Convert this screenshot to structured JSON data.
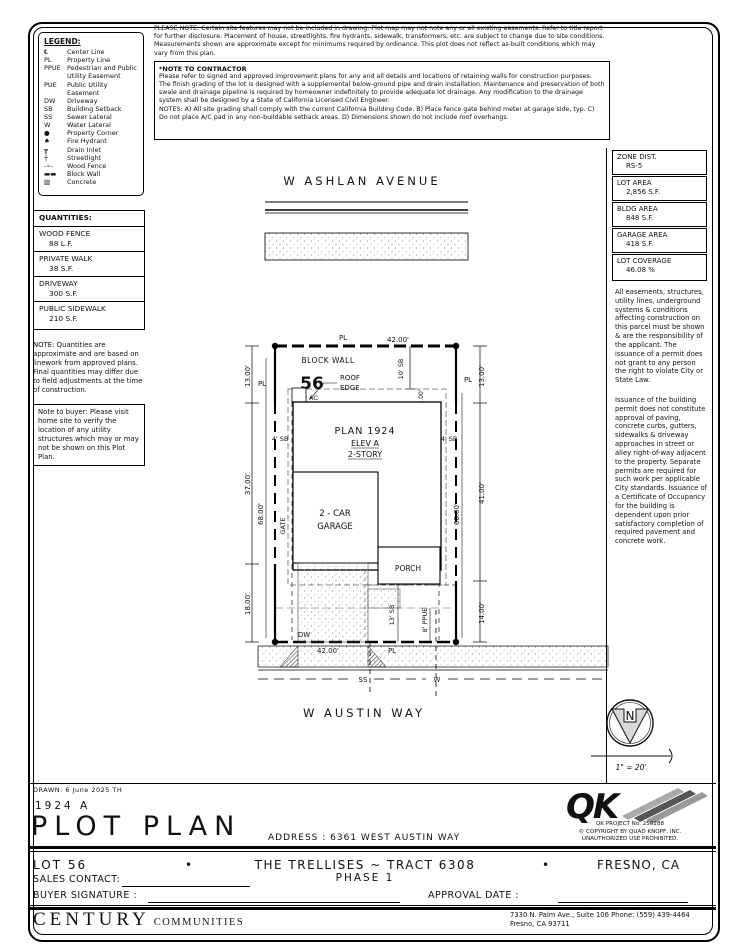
{
  "legend": {
    "title": "LEGEND:",
    "items": [
      {
        "symbol": "℄",
        "label": "Center Line"
      },
      {
        "symbol": "PL",
        "label": "Property Line"
      },
      {
        "symbol": "PPUE",
        "label": "Pedestrian and Public Utility Easement"
      },
      {
        "symbol": "PUE",
        "label": "Public Utility Easement"
      },
      {
        "symbol": "DW",
        "label": "Driveway"
      },
      {
        "symbol": "SB",
        "label": "Building Setback"
      },
      {
        "symbol": "SS",
        "label": "Sewer Lateral"
      },
      {
        "symbol": "W",
        "label": "Water Lateral"
      },
      {
        "symbol": "●",
        "label": "Property Corner"
      },
      {
        "symbol": "♠",
        "label": "Fire Hydrant"
      },
      {
        "symbol": "┳",
        "label": "Drain Inlet"
      },
      {
        "symbol": "┼",
        "label": "Streetlight"
      },
      {
        "symbol": "-∘-",
        "label": "Wood Fence"
      },
      {
        "symbol": "▬▬",
        "label": "Block Wall"
      },
      {
        "symbol": "▨",
        "label": "Concrete"
      }
    ]
  },
  "top_note": "PLEASE NOTE:  Certain site features may not be included in drawing.  Plot map may not note any or all existing easements. Refer to title report for further disclosure.  Placement of house, streetlights, fire hydrants, sidewalk, transformers, etc. are subject to change due to site conditions.  Measurements shown are approximate except for minimums required by ordinance.  This plot does not reflect as-built conditions which may vary from this plan.",
  "contractor_note": {
    "title": "*NOTE TO CONTRACTOR",
    "body": "Please refer to signed and approved improvement plans for any and all details and locations of retaining walls for construction purposes. The finish grading of the lot is designed with a supplemental below-ground pipe and drain installation.  Maintenance and preservation of both swale and drainage pipeline is required by homeowner indefinitely to provide adequate lot drainage.  Any modification to the drainage system shall be designed by a State of California Licensed Civil Engineer.",
    "notes": "NOTES:  A) All site grading shall comply with the current California Building Code.  B) Place fence gate behind meter at garage side, typ.  C) Do not place A/C pad in any non-buildable setback areas.  D) Dimensions shown do not include roof overhangs."
  },
  "site_info": {
    "boxes": [
      {
        "label": "ZONE DIST.",
        "value": "RS-5"
      },
      {
        "label": "LOT AREA",
        "value": "2,856 S.F."
      },
      {
        "label": "BLDG AREA",
        "value": "848 S.F."
      },
      {
        "label": "GARAGE AREA",
        "value": "418 S.F."
      },
      {
        "label": "LOT COVERAGE",
        "value": "46.08 %"
      }
    ],
    "para1": "All easements, structures, utility lines, underground systems & conditions affecting construction on this parcel must be shown & are the responsibility of the applicant. The issuance of a permit does not grant to any person the right to violate City or State Law.",
    "para2": "Issuance of the building permit does not constitute approval of paving, concrete curbs, gutters, sidewalks & driveway approaches in street or alley right-of-way adjacent to the property. Separate permits are required for such work per applicable City standards. Issuance of a Certificate of Occupancy for the building is dependent upon prior satisfactory completion of required pavement and concrete work."
  },
  "quantities": {
    "title": "QUANTITIES:",
    "items": [
      {
        "label": "WOOD FENCE",
        "value": "88 L.F."
      },
      {
        "label": "PRIVATE WALK",
        "value": "38 S.F."
      },
      {
        "label": "DRIVEWAY",
        "value": "300 S.F."
      },
      {
        "label": "PUBLIC SIDEWALK",
        "value": "210 S.F."
      }
    ],
    "note": "NOTE: Quantities are approximate and are based on linework from approved plans.  Final quantities may differ due to field adjustments at the time of construction.",
    "buyer_note": "Note to buyer: Please visit home site to verify the location of any utility structures which may or may not be shown on this Plot Plan."
  },
  "plot": {
    "labels": {
      "street_top": "W ASHLAN AVENUE",
      "street_bottom": "W AUSTIN WAY",
      "lot_width": "42.00'",
      "block_wall": "BLOCK WALL",
      "lot_number": "56",
      "pl": "PL",
      "roof1": "ROOF",
      "roof2": "EDGE",
      "ac": "AC",
      "sb10": "10' SB",
      "dim3": "3.00'",
      "plan": "PLAN 1924",
      "elev": "ELEV A",
      "story": "2-STORY",
      "sb4": "4' SB",
      "dim13": "13.00'",
      "dim37": "37.00'",
      "dim18": "18.00'",
      "dim68": "68.00'",
      "dim41": "41.00'",
      "dim14": "14.00'",
      "garage1": "2 - CAR",
      "garage2": "GARAGE",
      "gate": "GATE",
      "porch": "PORCH",
      "dw": "DW",
      "sb13": "13' SB",
      "ppue": "8' PPUE",
      "ss": "SS",
      "w": "W"
    }
  },
  "north": {
    "letter": "N",
    "scale": "1\" = 20'"
  },
  "title_block": {
    "drawn": "DRAWN:  6 June 2025  TH",
    "plan_code": "1924  A",
    "title": "PLOT PLAN",
    "address": "ADDRESS :  6361 WEST AUSTIN WAY",
    "lot": "LOT 56",
    "bullet": "•",
    "tract": "THE TRELLISES ~ TRACT 6308",
    "phase": "PHASE 1",
    "city": "FRESNO, CA",
    "sales_contact": "SALES CONTACT:",
    "buyer_signature": "BUYER SIGNATURE :",
    "approval_date": "APPROVAL DATE :"
  },
  "qk": {
    "logo": "QK",
    "project": "QK PROJECT No. 250288",
    "copyright": "©  COPYRIGHT BY QUAD KNOPF, INC.",
    "unauthorized": "UNAUTHORIZED USE PROHIBITED."
  },
  "footer": {
    "brand_main": "CENTURY",
    "brand_sub": "COMMUNITIES",
    "address_line1": "7330 N. Palm Ave., Suite 106    Phone:  (559) 439-4464",
    "address_line2": "Fresno, CA  93711"
  }
}
